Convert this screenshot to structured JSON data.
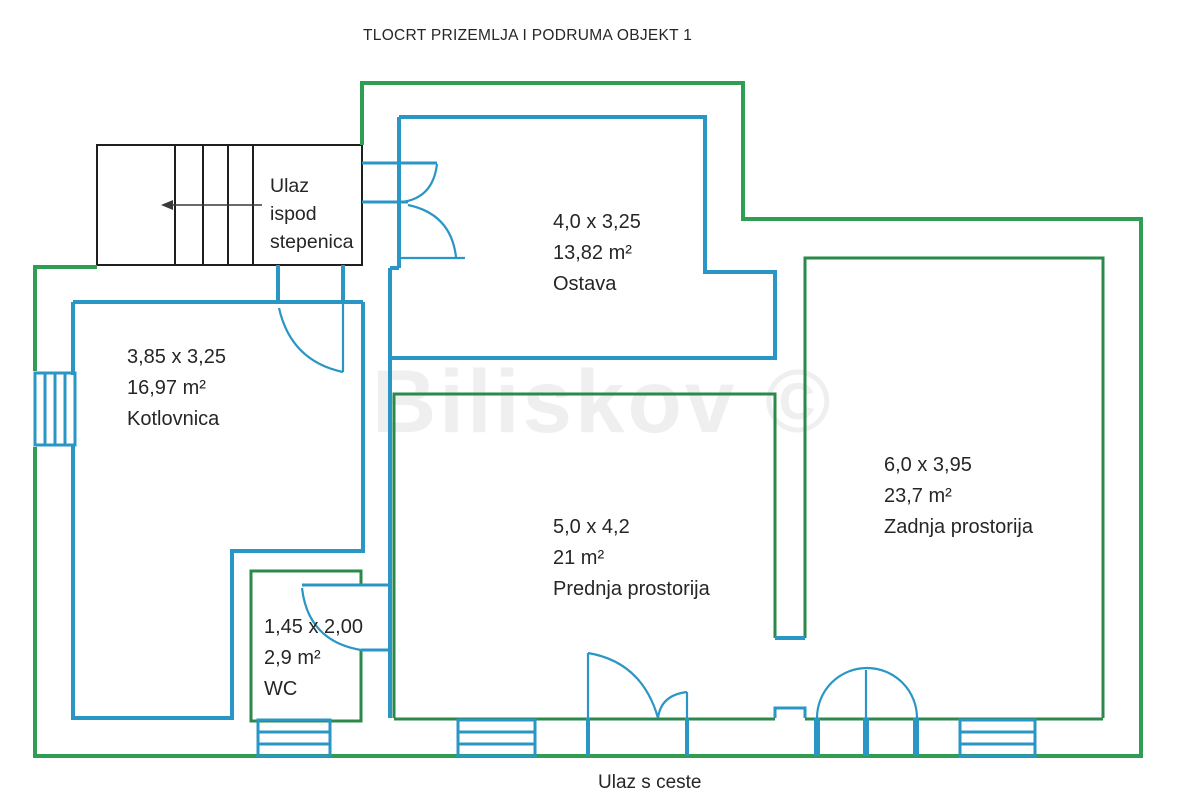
{
  "title": "TLOCRT PRIZEMLJA I PODRUMA OBJEKT 1",
  "watermark": "Biliskov ©",
  "entrance_bottom_label": "Ulaz s ceste",
  "stairs_lines": [
    "Ulaz",
    "ispod",
    "stepenica"
  ],
  "rooms": [
    {
      "dims": "4,0 x 3,25",
      "area": "13,82 m²",
      "name": "Ostava"
    },
    {
      "dims": "3,85 x 3,25",
      "area": "16,97 m²",
      "name": "Kotlovnica"
    },
    {
      "dims": "5,0 x 4,2",
      "area": "21 m²",
      "name": "Prednja prostorija"
    },
    {
      "dims": "6,0 x 3,95",
      "area": "23,7 m²",
      "name": "Zadnja prostorija"
    },
    {
      "dims": "1,45 x 2,00",
      "area": "2,9 m²",
      "name": "WC"
    }
  ],
  "colors": {
    "outer_wall_green": "#2f9e52",
    "room_green": "#2b8a4a",
    "wall_blue": "#2a96c5",
    "stairs_black": "#1f1f1f",
    "text": "#262626",
    "watermark_gray": "#efefef",
    "background": "#ffffff"
  }
}
